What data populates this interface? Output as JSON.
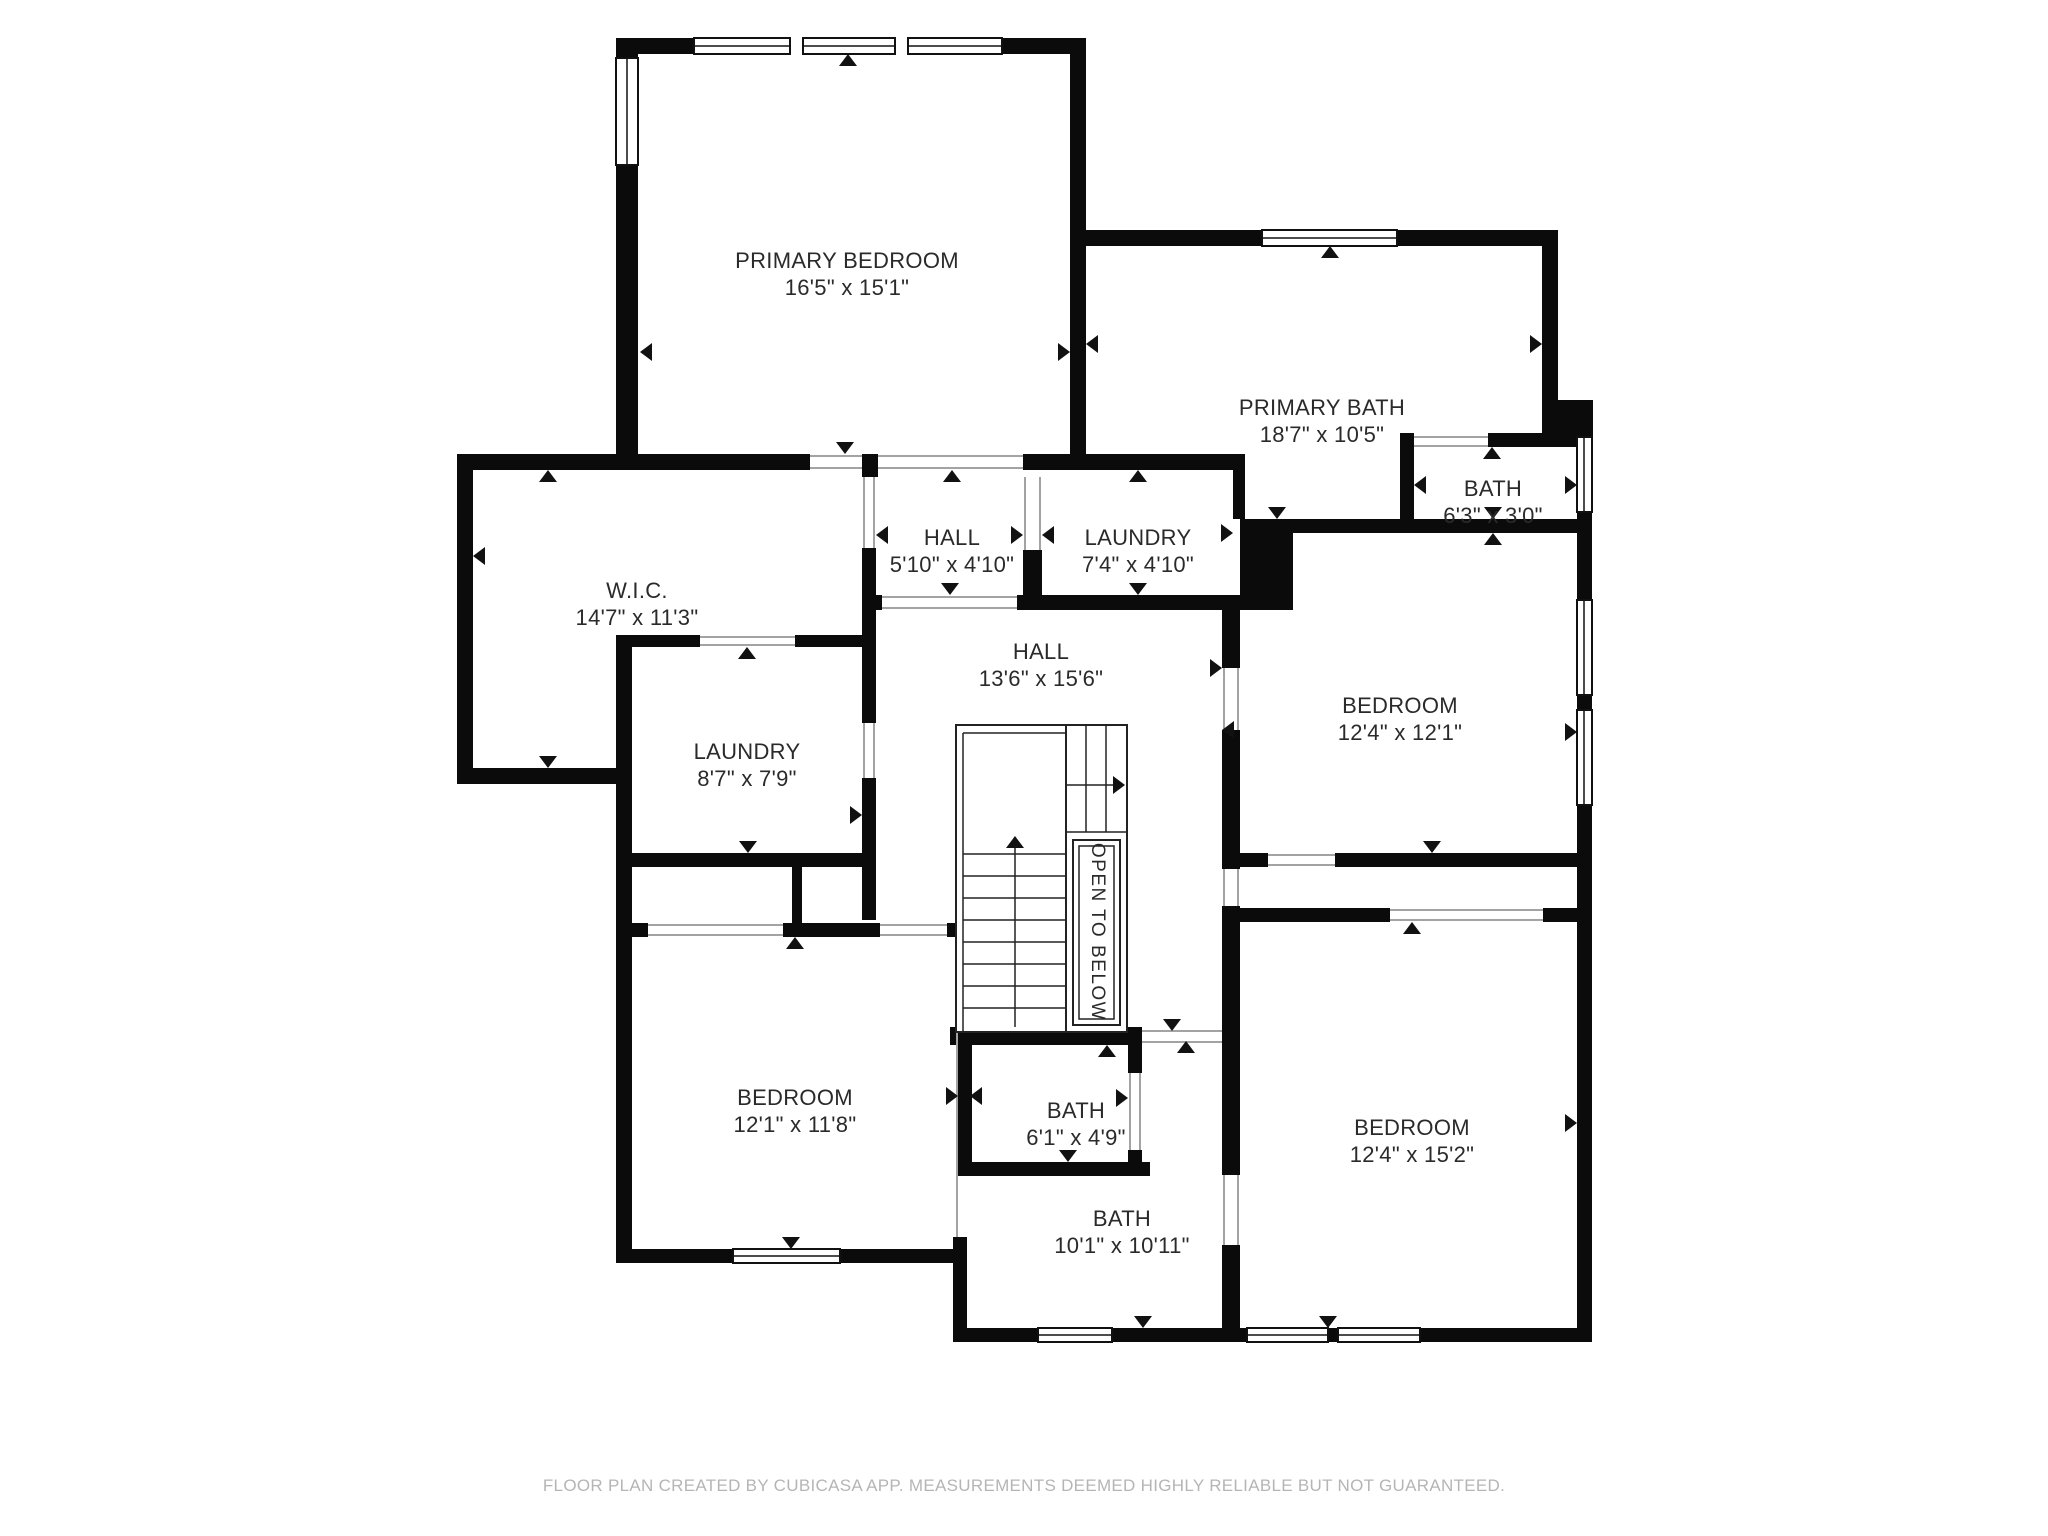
{
  "plan": {
    "rooms": [
      {
        "name": "PRIMARY BEDROOM",
        "dims": "16'5\" x 15'1\""
      },
      {
        "name": "PRIMARY BATH",
        "dims": "18'7\" x 10'5\""
      },
      {
        "name": "BATH",
        "dims": "6'3\" x 3'0\""
      },
      {
        "name": "HALL",
        "dims": "5'10\" x 4'10\""
      },
      {
        "name": "LAUNDRY",
        "dims": "7'4\" x 4'10\""
      },
      {
        "name": "W.I.C.",
        "dims": "14'7\" x 11'3\""
      },
      {
        "name": "HALL",
        "dims": "13'6\" x 15'6\""
      },
      {
        "name": "BEDROOM",
        "dims": "12'4\" x 12'1\""
      },
      {
        "name": "LAUNDRY",
        "dims": "8'7\" x 7'9\""
      },
      {
        "name": "BEDROOM",
        "dims": "12'1\" x 11'8\""
      },
      {
        "name": "BATH",
        "dims": "6'1\" x 4'9\""
      },
      {
        "name": "BATH",
        "dims": "10'1\" x 10'11\""
      },
      {
        "name": "BEDROOM",
        "dims": "12'4\" x 15'2\""
      }
    ],
    "stairs_label": "OPEN TO BELOW",
    "footer": "FLOOR PLAN CREATED BY CUBICASA APP. MEASUREMENTS DEEMED HIGHLY RELIABLE BUT NOT GUARANTEED.",
    "colors": {
      "wall": "#0b0b0b",
      "opening_line": "#a3a3a3",
      "label": "#2a2a2a",
      "footer": "#b5b5b5"
    }
  }
}
